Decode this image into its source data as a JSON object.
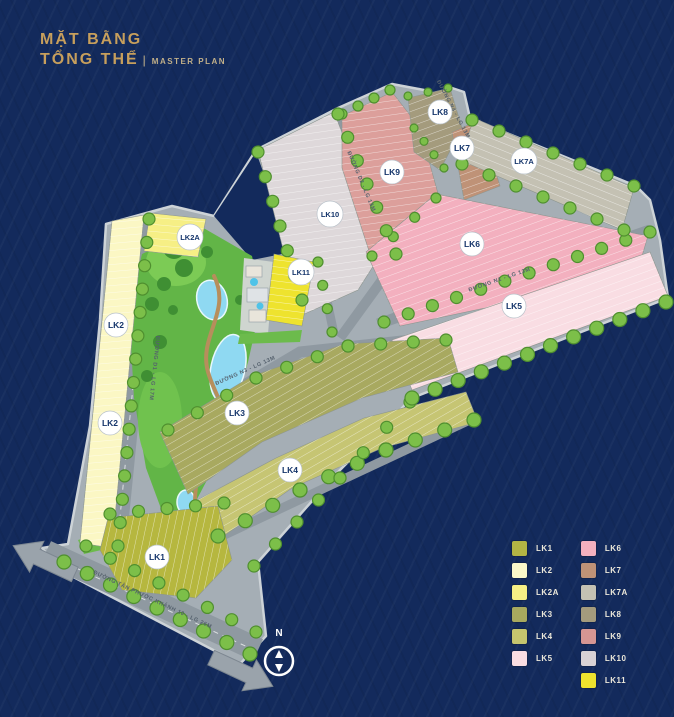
{
  "title": {
    "line1": "MẶT BẰNG",
    "line2": "TỔNG THỂ",
    "separator": "|",
    "subtitle": "MASTER PLAN"
  },
  "compass": {
    "label": "N"
  },
  "badges": {
    "lk1": "LK1",
    "lk2": "LK2",
    "lk2a": "LK2A",
    "lk3": "LK3",
    "lk4": "LK4",
    "lk5": "LK5",
    "lk6": "LK6",
    "lk7": "LK7",
    "lk7a": "LK7A",
    "lk8": "LK8",
    "lk9": "LK9",
    "lk10": "LK10",
    "lk11": "LK11"
  },
  "roads": {
    "d1": "ĐƯỜNG D1 - LG 17M",
    "tpk": "ĐƯỜNG TÂN PHƯỚC KHÁNH 10 - LG 26M",
    "n1": "ĐƯỜNG N1 - LG 13M",
    "d2": "ĐƯỜNG D2 - LG 13M",
    "n3": "ĐƯỜNG N3 - LG 13M",
    "n4": "ĐƯỜNG N4 - LG 13M"
  },
  "colors": {
    "lk1": "#b6b73f",
    "lk2": "#fbf7c4",
    "lk2a": "#f6ef85",
    "lk3": "#a8a960",
    "lk4": "#c6c573",
    "lk5": "#f9dde3",
    "lk6": "#f3b0bf",
    "lk7": "#bf9277",
    "lk7a": "#c4c1b3",
    "lk8": "#a49b7d",
    "lk9": "#dc9f9b",
    "lk10": "#ded8da",
    "lk11": "#eee32e",
    "base": "#a5aeb5",
    "road": "#8f99a1",
    "sidewalk": "#cdd3d7",
    "navy": "#132a5c",
    "tree": "#7cbf49",
    "treeDark": "#4f8f2f",
    "park": "#62b547",
    "lake": "#8fd9f2",
    "gold": "#c79f5c"
  },
  "legend": {
    "items": [
      {
        "label": "LK1",
        "color": "#b3b544"
      },
      {
        "label": "LK2",
        "color": "#fbf8c9"
      },
      {
        "label": "LK2A",
        "color": "#f6ef85"
      },
      {
        "label": "LK3",
        "color": "#a8a95e"
      },
      {
        "label": "LK4",
        "color": "#c5c56e"
      },
      {
        "label": "LK5",
        "color": "#f9dde3"
      },
      {
        "label": "LK6",
        "color": "#f3b0bf"
      },
      {
        "label": "LK7",
        "color": "#bf9277"
      },
      {
        "label": "LK7A",
        "color": "#c4c1b3"
      },
      {
        "label": "LK8",
        "color": "#a49b7d"
      },
      {
        "label": "LK9",
        "color": "#d69693"
      },
      {
        "label": "LK10",
        "color": "#d9d2d4"
      },
      {
        "label": "LK11",
        "color": "#eee32e"
      }
    ]
  }
}
